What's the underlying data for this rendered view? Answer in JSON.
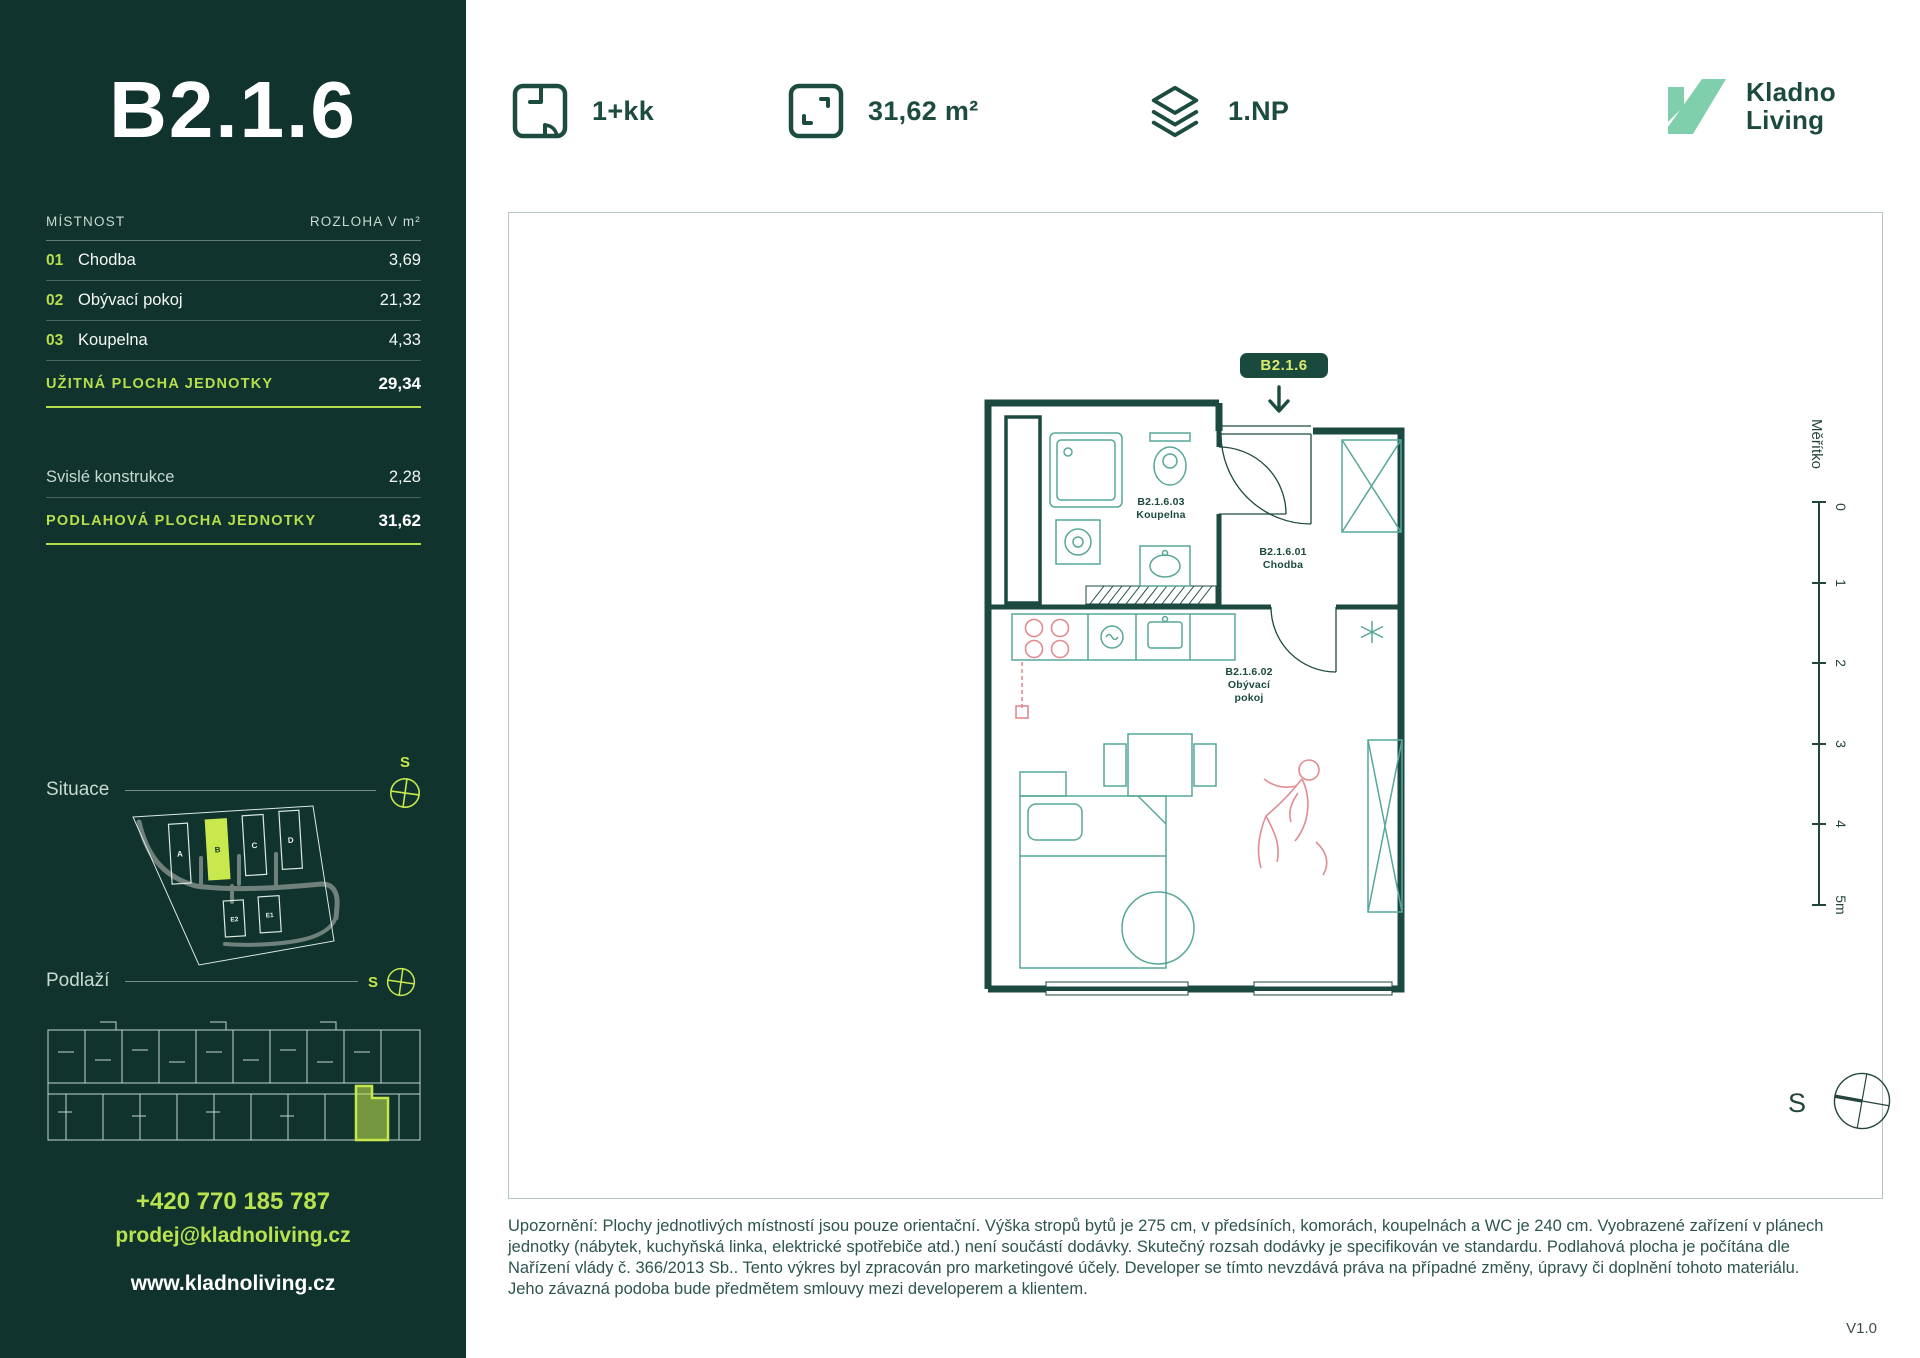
{
  "colors": {
    "sidebar_bg": "#10342d",
    "lime_accent": "#b7dd4c",
    "lime_bright": "#c8e84e",
    "badge_text": "#dbeb70",
    "dark_green": "#1b4a3f",
    "teal_fixture": "#57a79a",
    "pink_accent": "#e18b93",
    "mint_logo": "#7fcfad"
  },
  "sidebar": {
    "unit_title": "B2.1.6",
    "table": {
      "col_room": "MÍSTNOST",
      "col_area": "ROZLOHA V m²",
      "rows": [
        {
          "num": "01",
          "name": "Chodba",
          "area": "3,69"
        },
        {
          "num": "02",
          "name": "Obývací pokoj",
          "area": "21,32"
        },
        {
          "num": "03",
          "name": "Koupelna",
          "area": "4,33"
        }
      ],
      "usable_label": "UŽITNÁ PLOCHA JEDNOTKY",
      "usable_value": "29,34",
      "vertical_label": "Svislé konstrukce",
      "vertical_value": "2,28",
      "floor_label": "PODLAHOVÁ PLOCHA JEDNOTKY",
      "floor_value": "31,62"
    },
    "situace": {
      "label": "Situace",
      "compass_label": "S",
      "buildings": [
        "A",
        "B",
        "C",
        "D",
        "E2",
        "E1"
      ],
      "highlighted_building": "B"
    },
    "podlazi": {
      "label": "Podlaží",
      "compass_label": "S"
    },
    "contact": {
      "phone": "+420 770 185 787",
      "email": "prodej@kladnoliving.cz",
      "web": "www.kladnoliving.cz"
    }
  },
  "header": {
    "layout_type": "1+kk",
    "area": "31,62 m²",
    "floor": "1.NP",
    "logo_line1": "Kladno",
    "logo_line2": "Living"
  },
  "plan": {
    "badge": "B2.1.6",
    "compass_label": "S",
    "rooms": [
      {
        "code": "B2.1.6.03",
        "name": "Koupelna"
      },
      {
        "code": "B2.1.6.01",
        "name": "Chodba"
      },
      {
        "code": "B2.1.6.02",
        "name": "Obývací",
        "name2": "pokoj"
      }
    ]
  },
  "ruler": {
    "label": "Měřítko",
    "ticks": [
      "0",
      "1",
      "2",
      "3",
      "4",
      "5m"
    ]
  },
  "disclaimer": {
    "lines": [
      "Upozornění: Plochy jednotlivých místností jsou pouze orientační. Výška stropů bytů je 275 cm, v předsíních, komorách, koupelnách a WC je 240 cm. Vyobrazené zařízení v plánech",
      "jednotky (nábytek, kuchyňská linka, elektrické spotřebiče atd.) není součástí dodávky. Skutečný rozsah dodávky je specifikován ve standardu. Podlahová plocha je počítána dle",
      "Nařízení vlády č. 366/2013 Sb.. Tento výkres byl zpracován pro marketingové účely. Developer se tímto nevzdává práva na případné změny, úpravy či doplnění tohoto materiálu.",
      "Jeho závazná podoba bude předmětem smlouvy mezi developerem a klientem."
    ]
  },
  "version_label": "V1.0"
}
